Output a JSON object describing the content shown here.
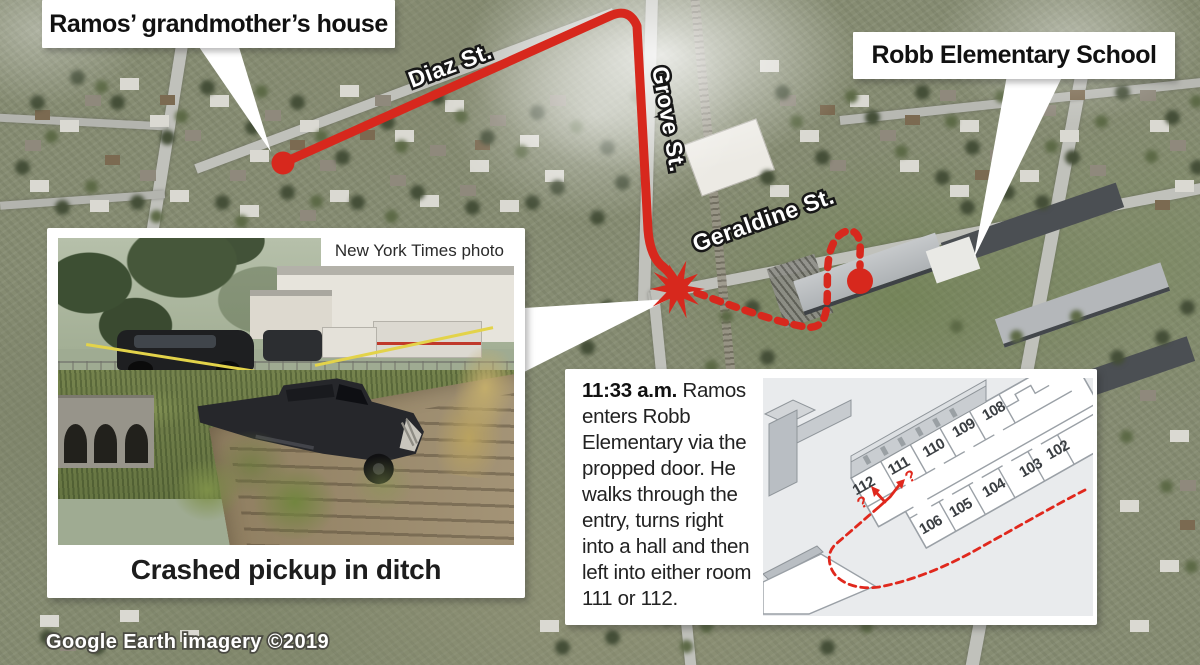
{
  "callouts": {
    "grandmother": "Ramos’ grandmother’s house",
    "school": "Robb Elementary School"
  },
  "map": {
    "streets": {
      "diaz": "Diaz St.",
      "grove": "Grove St.",
      "geraldine": "Geraldine St."
    },
    "credit": "Google Earth imagery ©2019"
  },
  "photo_inset": {
    "credit": "New York Times photo",
    "caption": "Crashed pickup in ditch"
  },
  "timeline": {
    "time": "11:33 a.m.",
    "text": "Ramos enters Robb Elementary via the propped door. He walks through the entry, turns right into a hall and then left into either room 111 or 112."
  },
  "floorplan": {
    "rooms": [
      "112",
      "111",
      "110",
      "109",
      "108",
      "106",
      "105",
      "104",
      "103",
      "102"
    ],
    "unknown_mark": "?"
  },
  "colors": {
    "route_red": "#d7281d"
  }
}
